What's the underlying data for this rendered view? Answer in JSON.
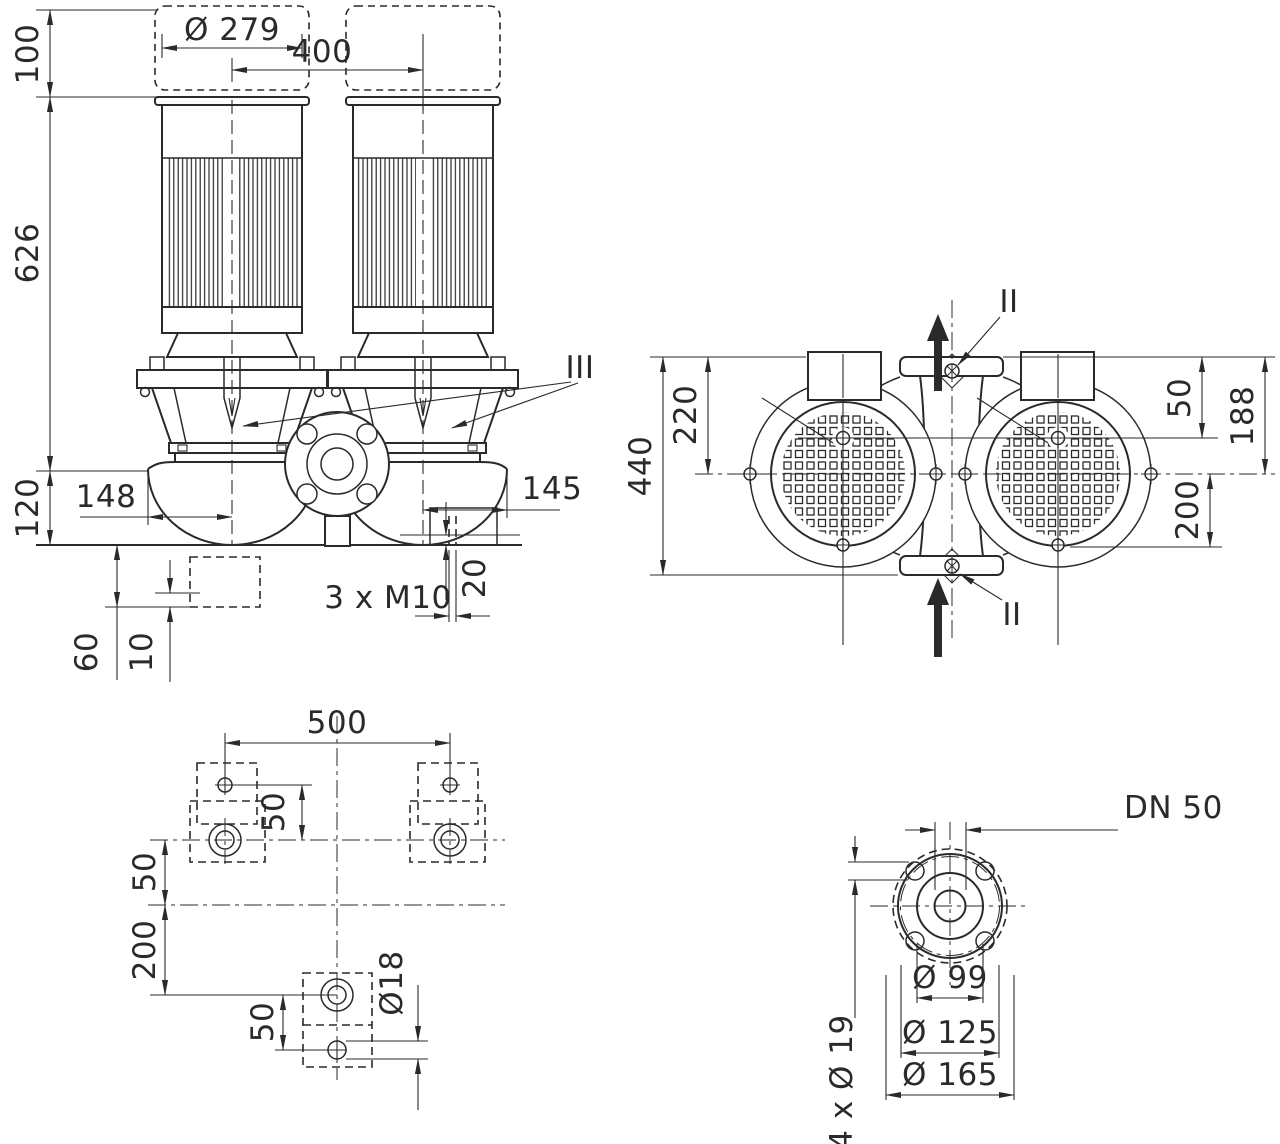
{
  "drawing_title": "Twin inline pump dimensional drawing",
  "colors": {
    "ink": "#2a2a2a",
    "background": "#ffffff"
  },
  "front": {
    "dia279": "Ø 279",
    "w400": "400",
    "h100": "100",
    "h626": "626",
    "h120": "120",
    "w148": "148",
    "w145": "145",
    "h20": "20",
    "m10": "3 x M10",
    "h60": "60",
    "h10": "10",
    "seal": "III"
  },
  "top": {
    "h440": "440",
    "h220": "220",
    "h50": "50",
    "h188": "188",
    "h200": "200",
    "plug_top": "II",
    "plug_bottom": "II"
  },
  "foundation": {
    "w500": "500",
    "pad50": "50",
    "left50": "50",
    "left200": "200",
    "bottom50": "50",
    "dia18": "Ø18"
  },
  "flange": {
    "dn": "DN 50",
    "dia99": "Ø 99",
    "dia125": "Ø 125",
    "dia165": "Ø 165",
    "bolts": "4 x Ø 19"
  }
}
